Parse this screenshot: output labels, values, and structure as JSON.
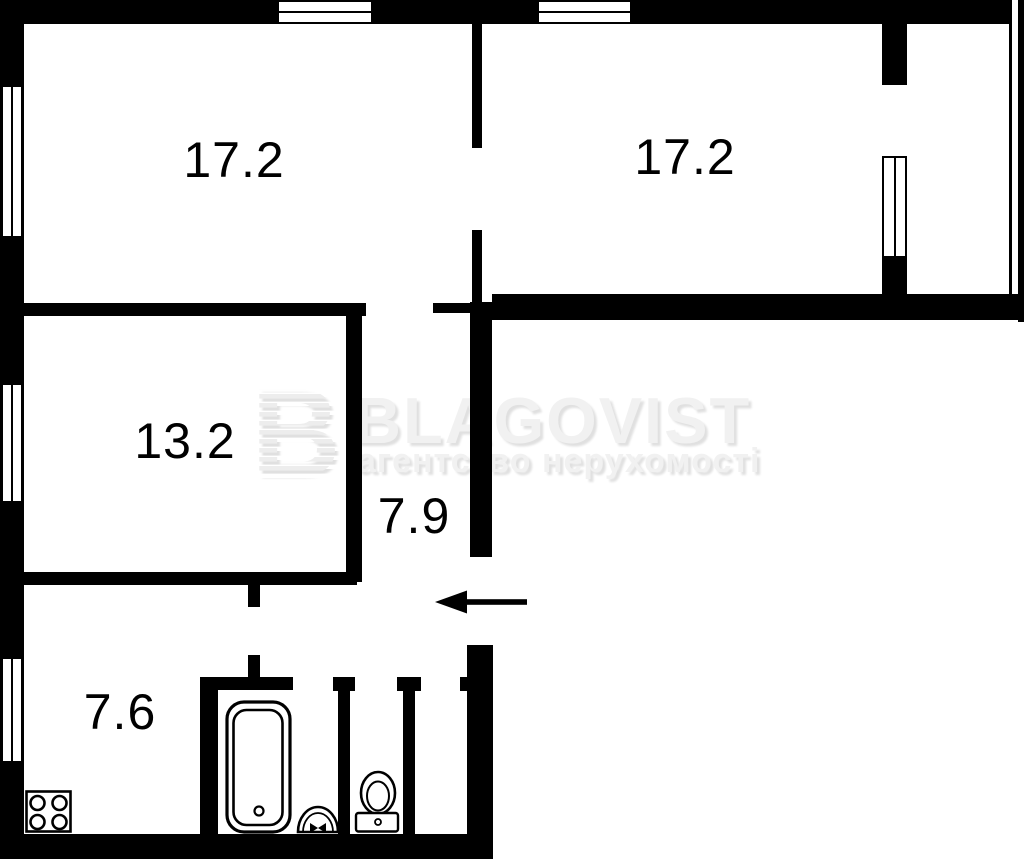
{
  "watermark": {
    "logo_letter": "B",
    "brand": "BLAGOVIST",
    "tagline": "агентство нерухомості"
  },
  "rooms": [
    {
      "id": "room-top-left",
      "area": "17.2"
    },
    {
      "id": "room-top-right",
      "area": "17.2"
    },
    {
      "id": "room-middle-left",
      "area": "13.2"
    },
    {
      "id": "hallway",
      "area": "7.9"
    },
    {
      "id": "kitchen",
      "area": "7.6"
    }
  ],
  "fixtures": [
    {
      "name": "stove"
    },
    {
      "name": "bathtub"
    },
    {
      "name": "sink"
    },
    {
      "name": "toilet"
    }
  ],
  "entry": {
    "arrow_direction": "left"
  },
  "colors": {
    "wall": "#000000",
    "background": "#ffffff",
    "label_text": "#000000",
    "watermark_fill": "#f1f1f1",
    "watermark_shadow": "#e0e0e0"
  }
}
